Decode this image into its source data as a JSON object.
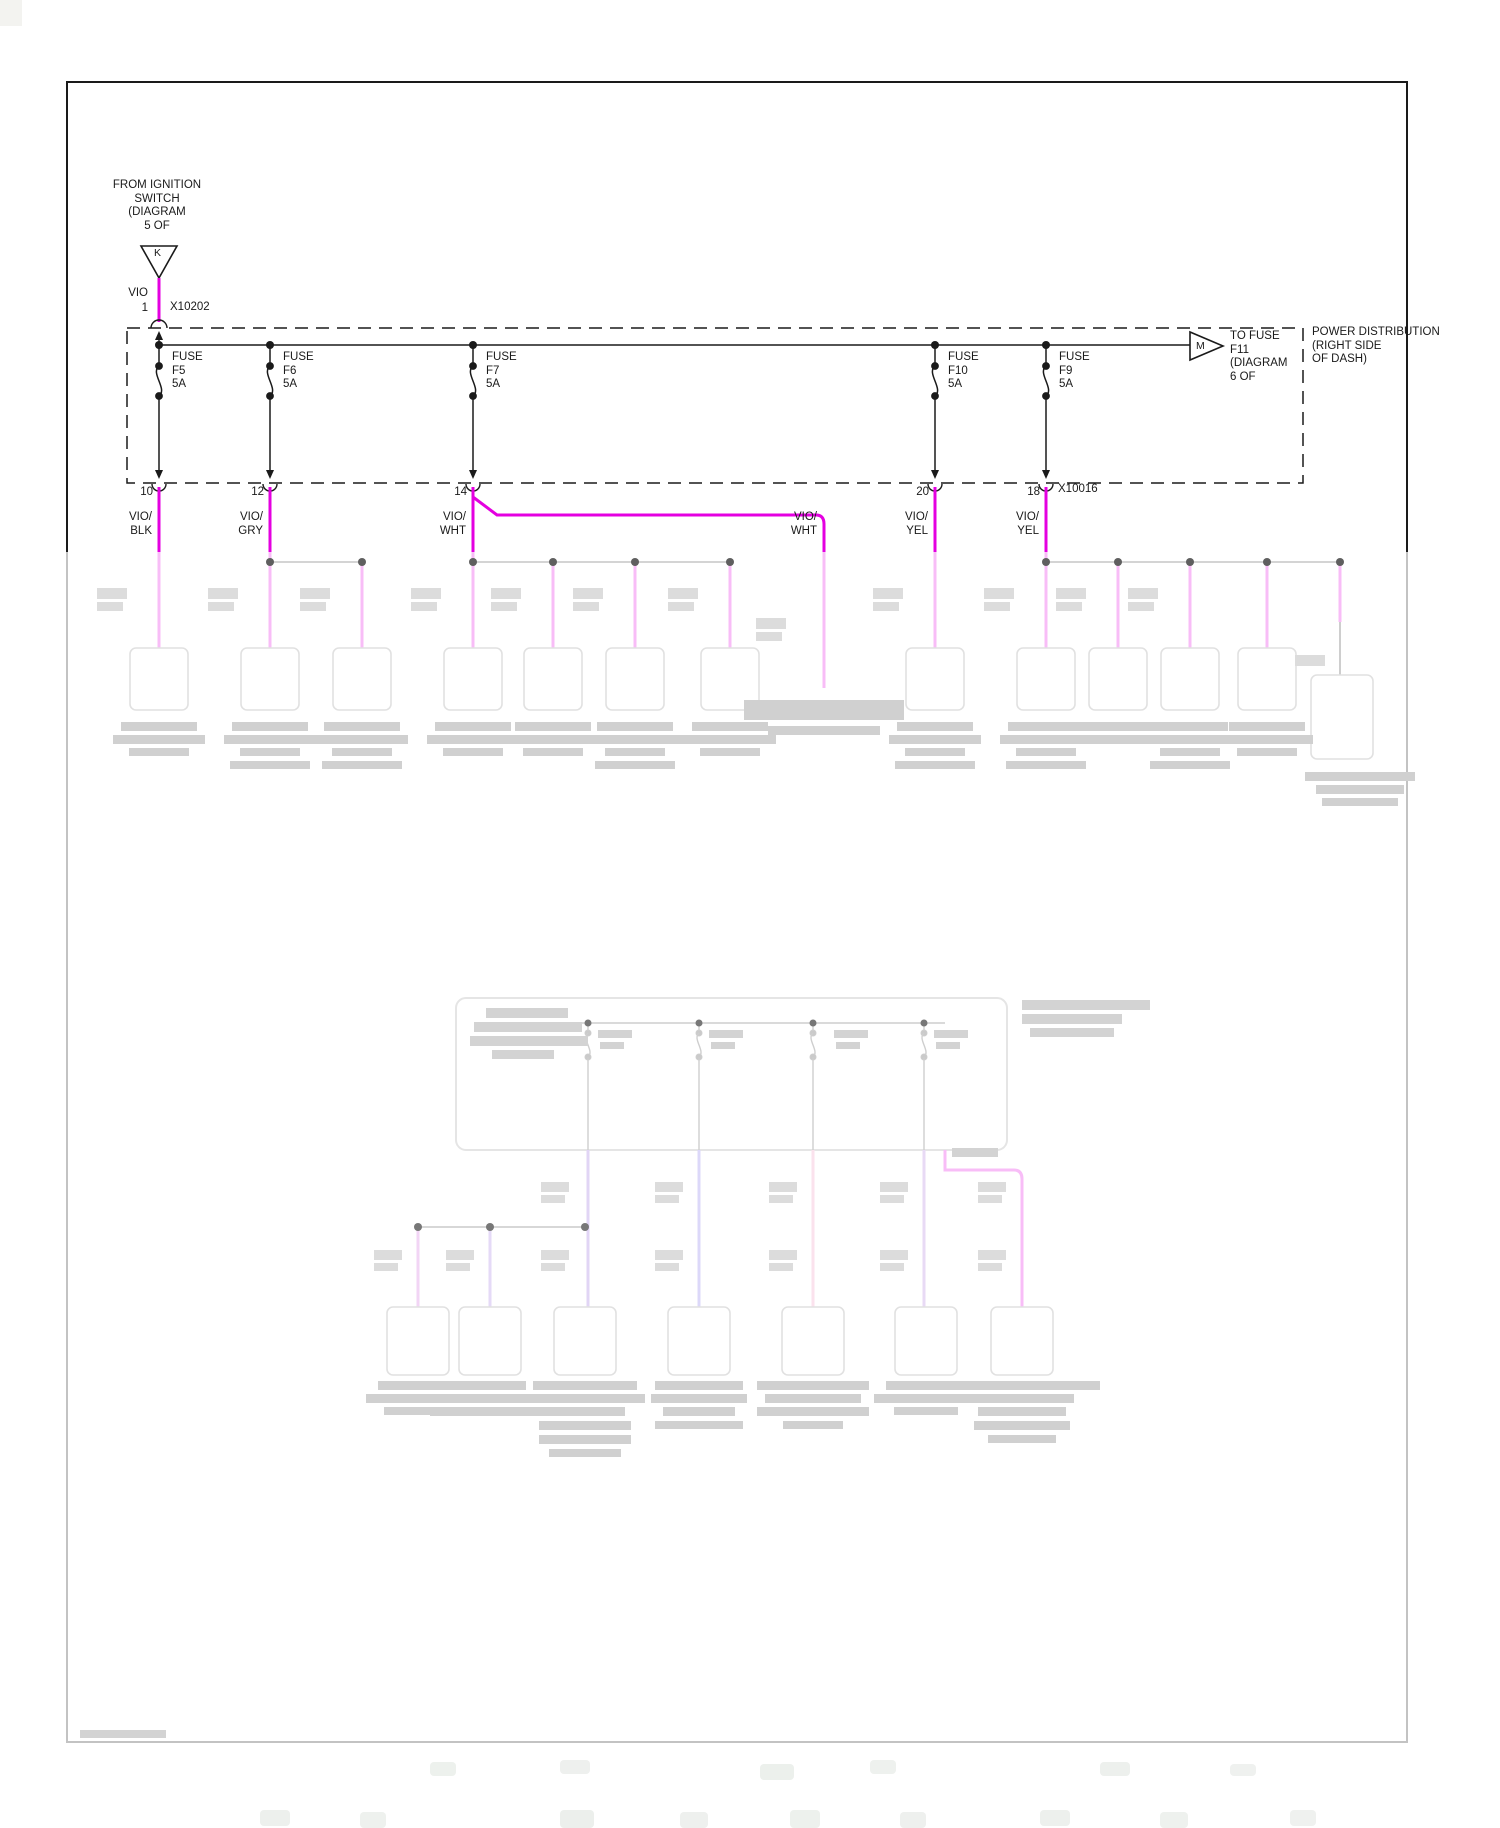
{
  "diagram": {
    "title_block": "POWER DISTRIBUTION (RIGHT SIDE OF DASH)",
    "source": {
      "lines": "FROM IGNITION\nSWITCH\n(DIAGRAM\n5 OF",
      "connector_letter": "K",
      "wire_color": "VIO",
      "pin": "1",
      "connector_id": "X10202"
    },
    "power_box": {
      "label_line1": "POWER DISTRIBUTION",
      "label_line2": "(RIGHT SIDE",
      "label_line3": "OF DASH)",
      "exit": {
        "connector_letter": "M",
        "lines": "TO FUSE\nF11\n(DIAGRAM\n6 OF"
      },
      "connector_out": "X10016",
      "fuses": [
        {
          "l1": "FUSE",
          "l2": "F5",
          "l3": "5A"
        },
        {
          "l1": "FUSE",
          "l2": "F6",
          "l3": "5A"
        },
        {
          "l1": "FUSE",
          "l2": "F7",
          "l3": "5A"
        },
        {
          "l1": "FUSE",
          "l2": "F10",
          "l3": "5A"
        },
        {
          "l1": "FUSE",
          "l2": "F9",
          "l3": "5A"
        }
      ]
    },
    "branches": [
      {
        "pin": "10",
        "w1": "VIO/",
        "w2": "BLK"
      },
      {
        "pin": "12",
        "w1": "VIO/",
        "w2": "GRY"
      },
      {
        "pin": "14",
        "w1": "VIO/",
        "w2": "WHT"
      },
      {
        "pin": "",
        "w1": "VIO/",
        "w2": "WHT"
      },
      {
        "pin": "20",
        "w1": "VIO/",
        "w2": "YEL"
      },
      {
        "pin": "18",
        "w1": "VIO/",
        "w2": "YEL"
      }
    ],
    "colors": {
      "vio_wire": "#E400E0",
      "faded_violet": "#8a5fd8",
      "faded_blue_violet": "#7a6ae8",
      "faded_pink": "#ef8fb8",
      "faded_purple": "#a86fd8",
      "line_black": "#1a1a1a"
    }
  }
}
